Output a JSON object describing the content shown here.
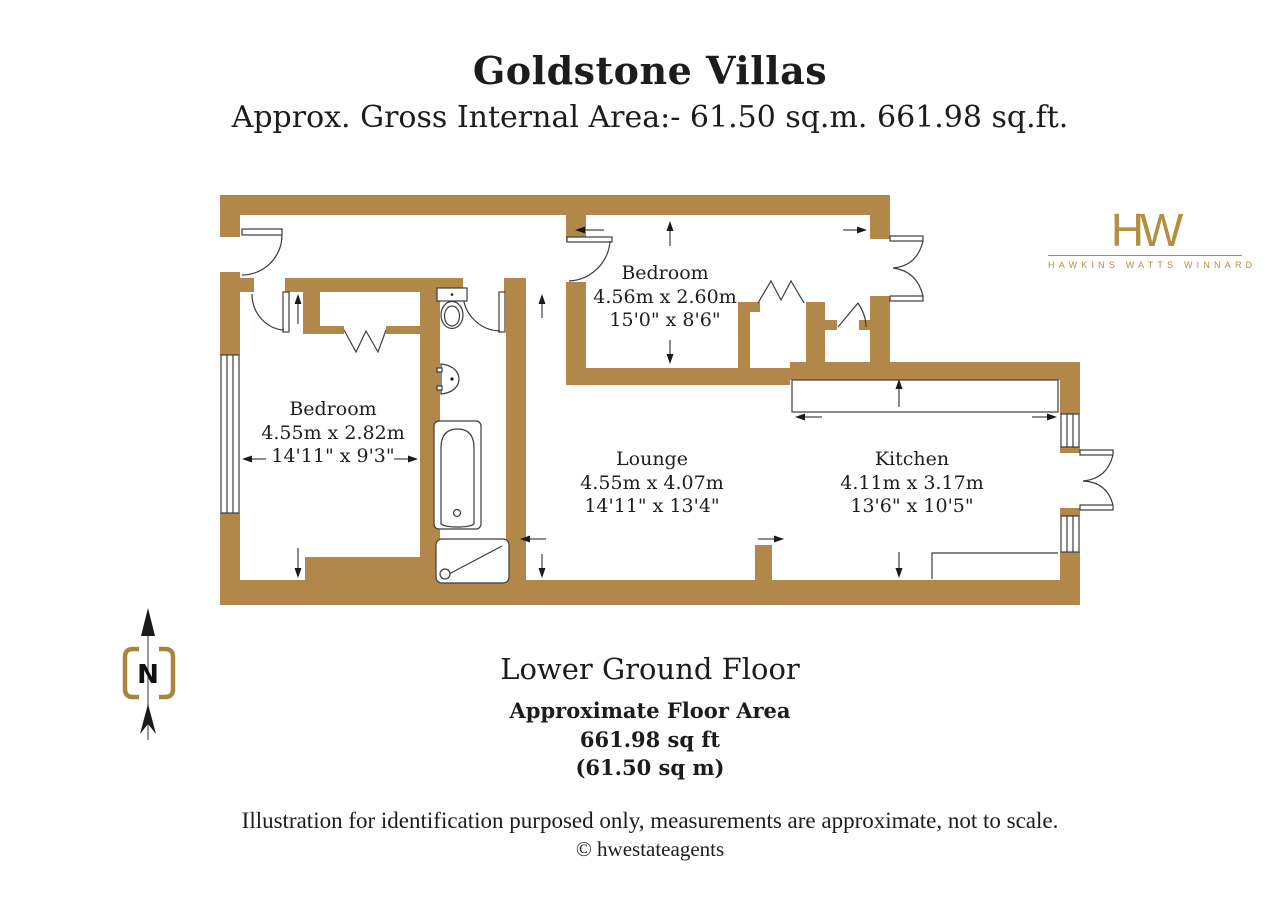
{
  "type": "estate-agent-floorplan",
  "header": {
    "title": "Goldstone Villas",
    "subtitle": "Approx. Gross Internal Area:- 61.50 sq.m. 661.98 sq.ft."
  },
  "logo": {
    "monogram": "HW",
    "name": "HAWKINS WATTS WINNARD"
  },
  "compass": {
    "label": "N"
  },
  "rooms": [
    {
      "name": "Bedroom",
      "metric": "4.56m x 2.60m",
      "imperial": "15'0\" x 8'6\""
    },
    {
      "name": "Bedroom",
      "metric": "4.55m x 2.82m",
      "imperial": "14'11\" x 9'3\""
    },
    {
      "name": "Lounge",
      "metric": "4.55m x 4.07m",
      "imperial": "14'11\" x 13'4\""
    },
    {
      "name": "Kitchen",
      "metric": "4.11m x 3.17m",
      "imperial": "13'6\" x 10'5\""
    }
  ],
  "floor": {
    "name": "Lower Ground Floor",
    "area_heading": "Approximate Floor Area",
    "area_sqft": "661.98 sq ft",
    "area_sqm": "(61.50 sq m)"
  },
  "footer": {
    "disclaimer": "Illustration for identification purposed only, measurements are approximate, not to scale.",
    "copyright": "© hwestateagents"
  },
  "colors": {
    "wall": "#B2884A",
    "logo_gold": "#B1903F",
    "line": "#3C3C3C"
  }
}
